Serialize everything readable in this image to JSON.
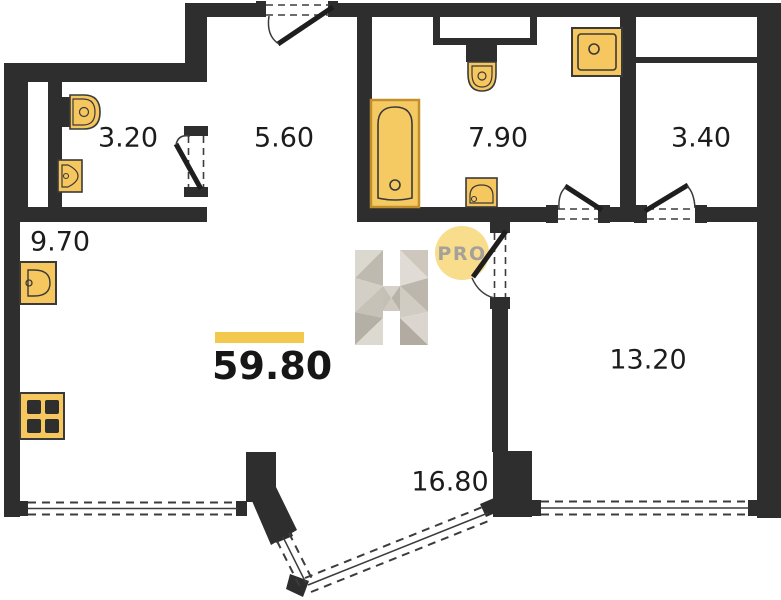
{
  "plan": {
    "total": {
      "area": "59.80"
    },
    "rooms": [
      {
        "name": "wc",
        "area": "3.20"
      },
      {
        "name": "hallway",
        "area": "5.60"
      },
      {
        "name": "bathroom",
        "area": "7.90"
      },
      {
        "name": "storage",
        "area": "3.40"
      },
      {
        "name": "kitchen",
        "area": "9.70"
      },
      {
        "name": "bedroom",
        "area": "13.20"
      },
      {
        "name": "living-room",
        "area": "16.80"
      }
    ],
    "watermark": {
      "letter": "H",
      "badge": "PRO"
    },
    "fixtures": [
      "toilet",
      "sink",
      "bathtub",
      "shower-tray",
      "stove",
      "kitchen-sink"
    ],
    "colors": {
      "wall": "#2e2e2e",
      "fixture_fill": "#f6c75f",
      "tub_border": "#c18f2c",
      "accent_bar": "#f2c94c",
      "badge_bg": "#f8dd8c",
      "badge_text": "#a5a19a"
    }
  }
}
